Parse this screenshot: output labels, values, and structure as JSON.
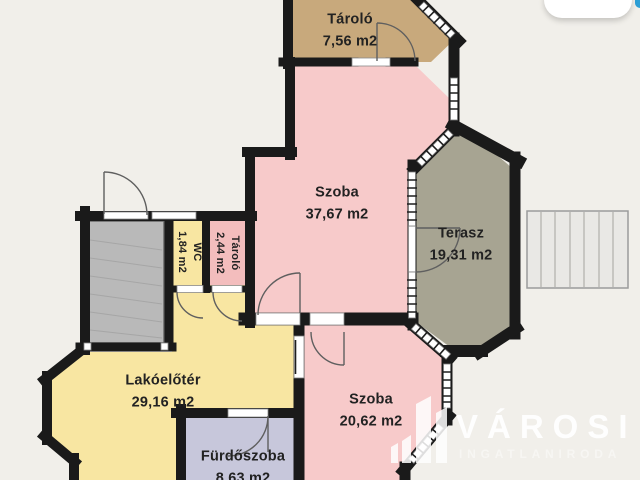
{
  "plan": {
    "rooms": [
      {
        "name": "Tároló",
        "area": "7,56 m2"
      },
      {
        "name": "Szoba",
        "area": "37,67 m2"
      },
      {
        "name": "Terasz",
        "area": "19,31 m2"
      },
      {
        "name": "WC",
        "area": "1,84 m2"
      },
      {
        "name": "Tároló",
        "area": "2,44 m2"
      },
      {
        "name": "Lakóelőtér",
        "area": "29,16 m2"
      },
      {
        "name": "Szoba",
        "area": "20,62 m2"
      },
      {
        "name": "Fürdőszoba",
        "area": "8,63 m2"
      }
    ]
  },
  "watermark": {
    "brand": "VÁROSI",
    "tagline": "INGATLANIRODA"
  },
  "colors": {
    "background": "#f1efea",
    "wall": "#1a1a1a",
    "room_tan": "#c8a97c",
    "room_pink": "#f7caca",
    "room_pink_deep": "#f3bdbd",
    "room_yellow": "#f8e6a2",
    "room_lavender": "#c7c7db",
    "terrace_gray": "#a7a492",
    "stair_gray": "#b9b9b9",
    "outdoor_stairs": "#e9e8e5",
    "accent_blue": "#2d9fd6"
  }
}
